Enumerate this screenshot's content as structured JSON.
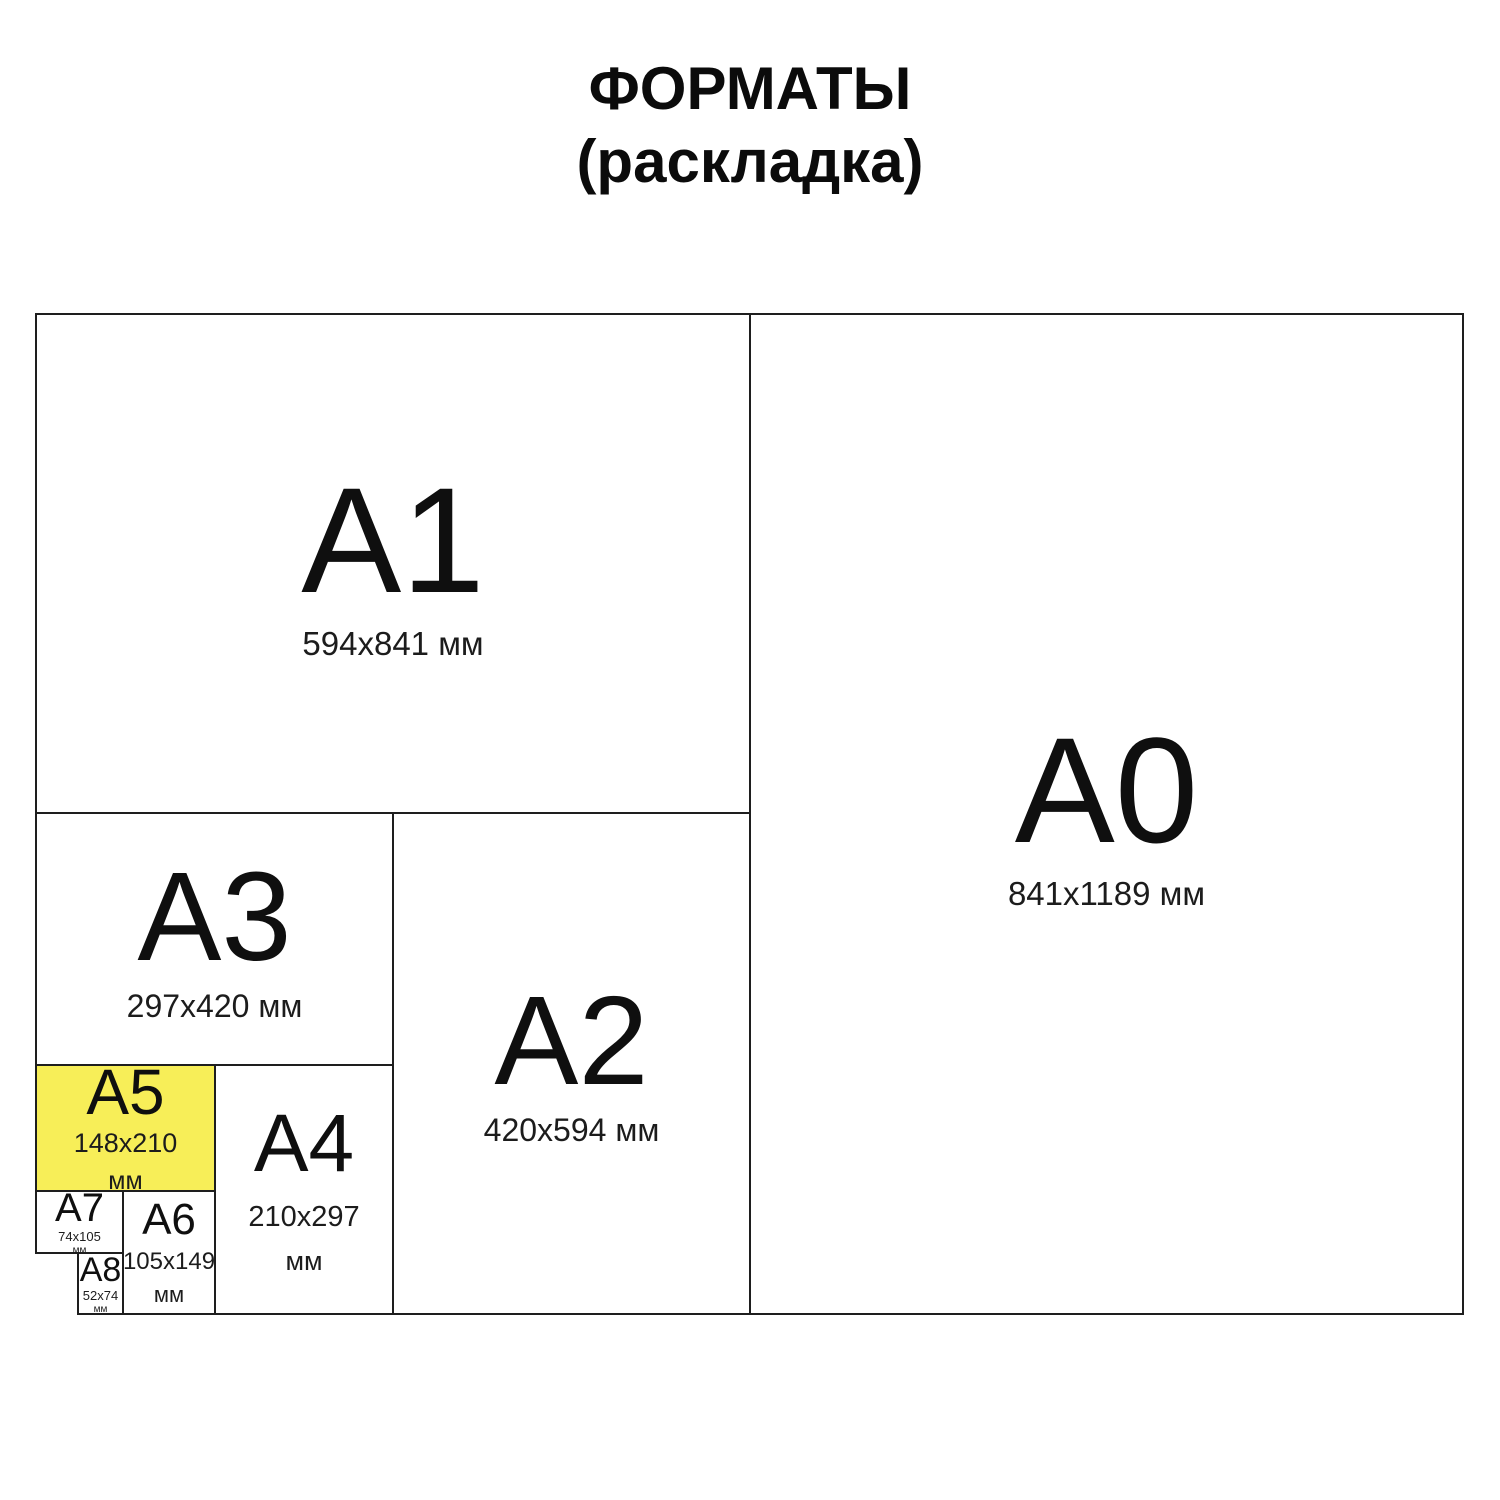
{
  "title": {
    "line1": "ФОРМАТЫ",
    "line2": "(раскладка)"
  },
  "formats": {
    "a0": {
      "name": "A0",
      "dims": "841x1189 мм"
    },
    "a1": {
      "name": "A1",
      "dims": "594x841 мм"
    },
    "a2": {
      "name": "A2",
      "dims": "420x594 мм"
    },
    "a3": {
      "name": "A3",
      "dims": "297x420 мм"
    },
    "a4": {
      "name": "A4",
      "dims": "210x297",
      "unit": "мм"
    },
    "a5": {
      "name": "A5",
      "dims": "148x210",
      "unit": "мм",
      "highlighted": true
    },
    "a6": {
      "name": "A6",
      "dims": "105x149",
      "unit": "мм"
    },
    "a7": {
      "name": "A7",
      "dims": "74x105",
      "unit": "мм"
    },
    "a8": {
      "name": "A8",
      "dims": "52x74",
      "unit": "мм"
    }
  },
  "colors": {
    "highlight": "#F7EE58",
    "border": "#1E1E1E",
    "text": "#111111",
    "background": "#FFFFFF"
  }
}
